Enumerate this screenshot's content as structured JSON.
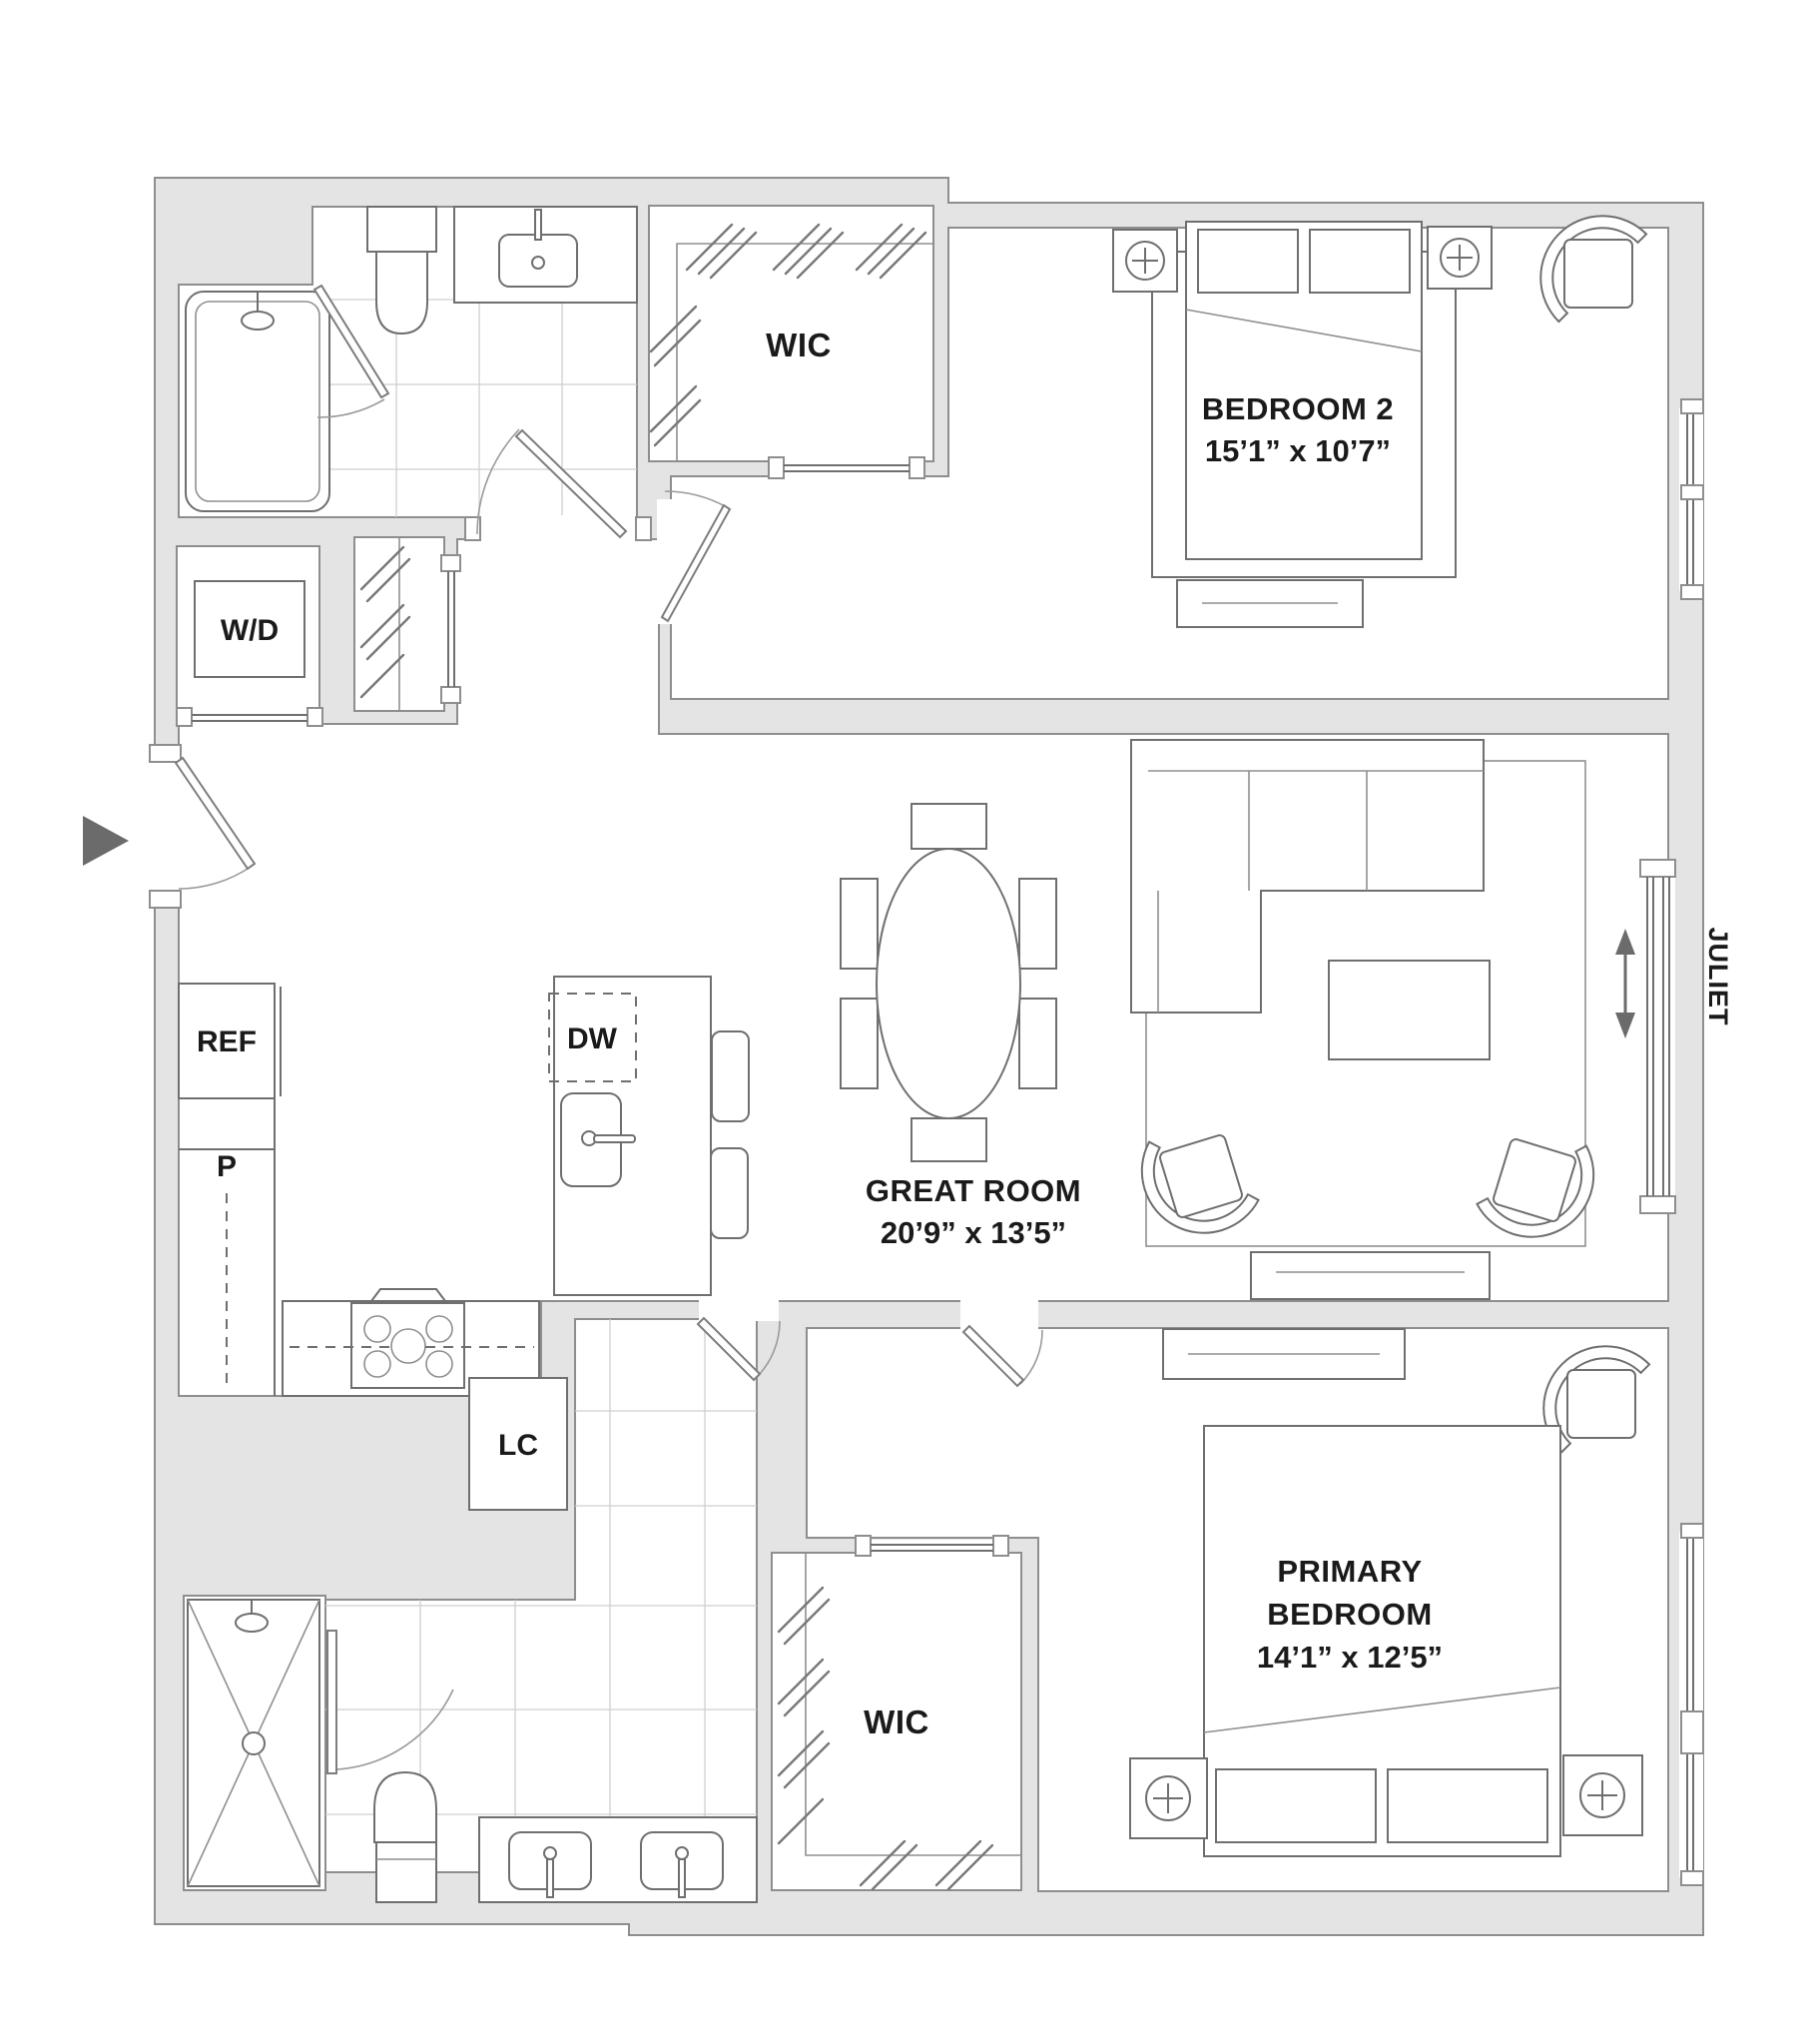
{
  "meta": {
    "type": "apartment-floor-plan",
    "units": "feet-inches"
  },
  "colors": {
    "wall_fill": "#e4e4e4",
    "wall_stroke": "#8e8e8e",
    "fixture_stroke": "#6f6f6f",
    "text": "#1a1a1a",
    "arrow": "#6b6b6b",
    "background": "#ffffff"
  },
  "labels": {
    "wic_top": "WIC",
    "wic_bottom": "WIC",
    "wd": "W/D",
    "ref": "REF",
    "pantry": "P",
    "dw": "DW",
    "lc": "LC",
    "juliet": "JULIET"
  },
  "rooms": {
    "bedroom2": {
      "name": "BEDROOM 2",
      "dims": "15’1” x 10’7”"
    },
    "great_room": {
      "name": "GREAT ROOM",
      "dims": "20’9” x 13’5”"
    },
    "primary_bedroom": {
      "name_line1": "PRIMARY",
      "name_line2": "BEDROOM",
      "dims": "14’1” x 12’5”"
    }
  }
}
